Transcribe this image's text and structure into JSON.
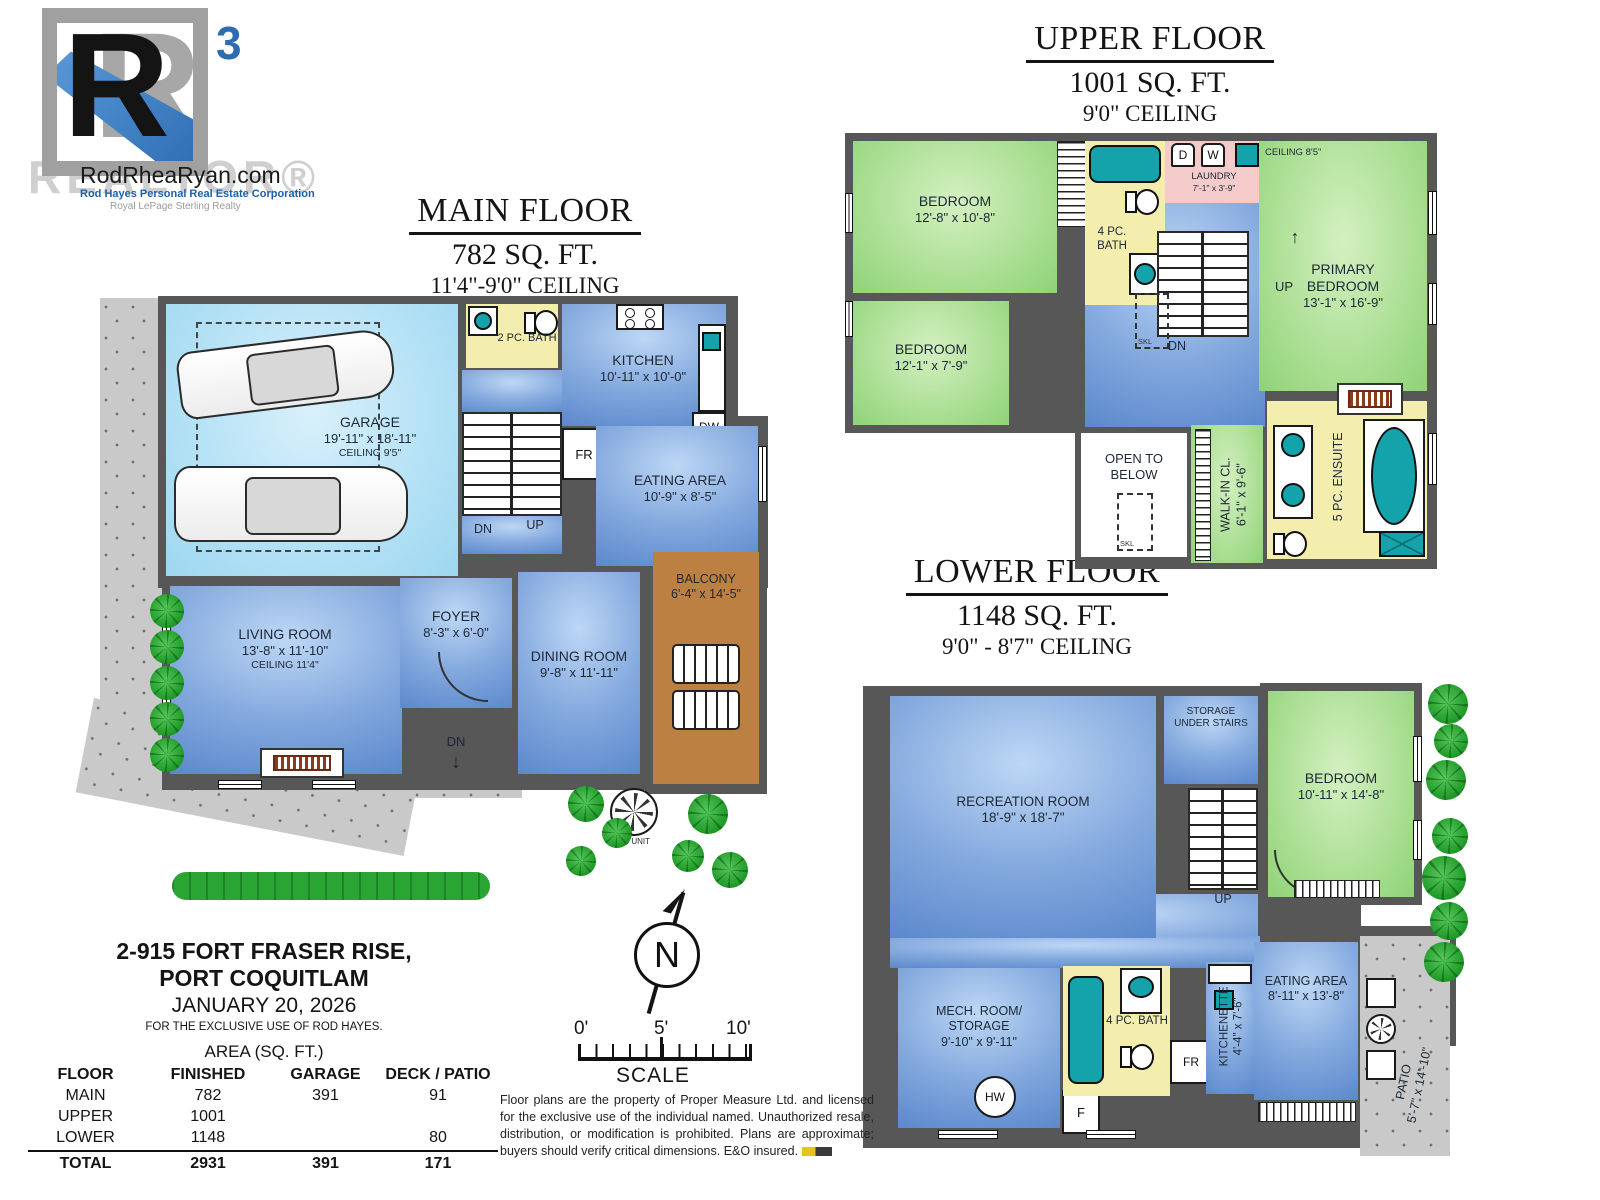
{
  "brand": {
    "letter_shadow": "R",
    "letter": "R",
    "superscript": "3",
    "website": "RodRheaRyan.com",
    "subtitle1": "Rod Hayes Personal Real Estate Corporation",
    "subtitle2": "Royal LePage Sterling Realty",
    "watermark": "REALTOR®"
  },
  "main_floor": {
    "title": "MAIN FLOOR",
    "area": "782 SQ. FT.",
    "ceiling": "11'4\"-9'0\" CEILING",
    "garage": {
      "name": "GARAGE",
      "dims": "19'-11\" x 18'-11\"",
      "ceiling": "CEILING 9'5\""
    },
    "bath": {
      "name": "2 PC. BATH"
    },
    "kitchen": {
      "name": "KITCHEN",
      "dims": "10'-11\" x 10'-0\""
    },
    "eating": {
      "name": "EATING AREA",
      "dims": "10'-9\" x 8'-5\""
    },
    "living": {
      "name": "LIVING ROOM",
      "dims": "13'-8\" x 11'-10\"",
      "ceiling": "CEILING 11'4\""
    },
    "foyer": {
      "name": "FOYER",
      "dims": "8'-3\" x 6'-0\""
    },
    "dining": {
      "name": "DINING ROOM",
      "dims": "9'-8\" x 11'-11\""
    },
    "balcony": {
      "name": "BALCONY",
      "dims": "6'-4\" x 14'-5\""
    },
    "labels": {
      "dn_stairs": "DN",
      "up_stairs": "UP",
      "fr": "FR",
      "dw": "DW",
      "dn_porch": "DN",
      "down_arrow": "↓",
      "ac_unit": "AC UNIT"
    }
  },
  "upper_floor": {
    "title": "UPPER FLOOR",
    "area": "1001 SQ. FT.",
    "ceiling": "9'0\" CEILING",
    "bedroom1": {
      "name": "BEDROOM",
      "dims": "12'-8\" x 10'-8\""
    },
    "bedroom2": {
      "name": "BEDROOM",
      "dims": "12'-1\" x 7'-9\""
    },
    "bath": {
      "name": "4 PC. BATH"
    },
    "laundry": {
      "name": "LAUNDRY",
      "dims": "7'-1\" x 3'-9\"",
      "dryer": "D",
      "washer": "W"
    },
    "primary": {
      "name": "PRIMARY BEDROOM",
      "dims": "13'-1\" x 16'-9\"",
      "ceiling_note": "CEILING 8'5\""
    },
    "open_below": {
      "name": "OPEN TO BELOW",
      "skl": "SKL"
    },
    "walkin": {
      "name": "WALK-IN CL.",
      "dims": "6'-1\" x 9'-6\""
    },
    "ensuite": {
      "name": "5 PC. ENSUITE"
    },
    "labels": {
      "dn": "DN",
      "up": "UP",
      "up_arrow": "↑",
      "skl": "SKL"
    }
  },
  "lower_floor": {
    "title": "LOWER FLOOR",
    "area": "1148 SQ. FT.",
    "ceiling": "9'0\" - 8'7\" CEILING",
    "rec": {
      "name": "RECREATION ROOM",
      "dims": "18'-9\" x 18'-7\""
    },
    "storage": {
      "name": "STORAGE UNDER STAIRS"
    },
    "bedroom": {
      "name": "BEDROOM",
      "dims": "10'-11\" x 14'-8\""
    },
    "mech": {
      "name": "MECH. ROOM/ STORAGE",
      "dims": "9'-10\" x 9'-11\""
    },
    "bath": {
      "name": "4 PC. BATH"
    },
    "kitchenette": {
      "name": "KITCHENETTE",
      "dims": "4'-4\" x 7'-6\""
    },
    "eating": {
      "name": "EATING AREA",
      "dims": "8'-11\" x 13'-8\""
    },
    "patio": {
      "name": "PATIO",
      "dims": "5'-7\" x 14'-10\""
    },
    "labels": {
      "up": "UP",
      "up_arrow": "↑",
      "hw": "HW",
      "f": "F",
      "fr": "FR"
    }
  },
  "info": {
    "address_line1": "2-915 FORT FRASER RISE,",
    "address_line2": "PORT COQUITLAM",
    "date": "JANUARY 20, 2026",
    "exclusive": "FOR THE EXCLUSIVE USE OF ROD HAYES.",
    "table": {
      "caption": "AREA (SQ. FT.)",
      "headers": [
        "FLOOR",
        "FINISHED",
        "GARAGE",
        "DECK / PATIO"
      ],
      "rows": [
        [
          "MAIN",
          "782",
          "391",
          "91"
        ],
        [
          "UPPER",
          "1001",
          "",
          ""
        ],
        [
          "LOWER",
          "1148",
          "",
          "80"
        ],
        [
          "TOTAL",
          "2931",
          "391",
          "171"
        ]
      ]
    }
  },
  "compass": {
    "n": "N"
  },
  "scale": {
    "t0": "0'",
    "t5": "5'",
    "t10": "10'",
    "label": "SCALE"
  },
  "disclaimer": "Floor plans are the property of Proper Measure Ltd. and licensed for the exclusive use of the individual named. Unauthorized resale, distribution, or modification is prohibited. Plans are approximate; buyers should verify critical dimensions. E&O insured."
}
